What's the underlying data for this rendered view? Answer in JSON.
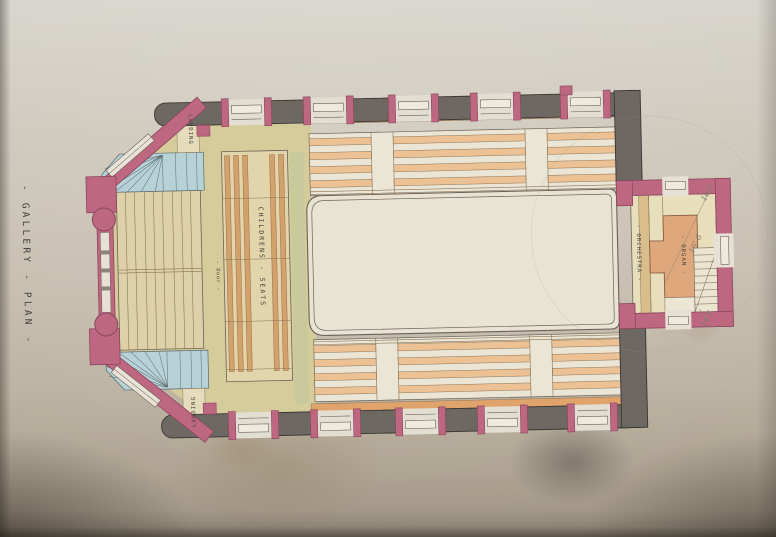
{
  "drawing": {
    "title": "- GALLERY - PLAN -",
    "labels": {
      "landing_top": "LANDING",
      "landing_bottom": "LANDING",
      "childrens_seats": "CHILDRENS - SEATS",
      "door": "- Door -",
      "orchestra": "- ORCHESTRA -",
      "organ": "- ORGAN -"
    },
    "pencil_notes": [
      "16.6",
      "16' 6",
      "14.6"
    ],
    "palette": {
      "paper": "#c7bfb0",
      "brick_pink": "#bd6880",
      "stone_gray": "#6e6862",
      "stair_blue": "#b7d2d6",
      "floor_wash": "#d6cc9b",
      "pew_cream": "#e2d4ab",
      "seat_orange": "#e4b285",
      "organ_orange": "#dfa87c",
      "well_cream": "#e9e3d3",
      "ink": "#4a443c"
    }
  }
}
